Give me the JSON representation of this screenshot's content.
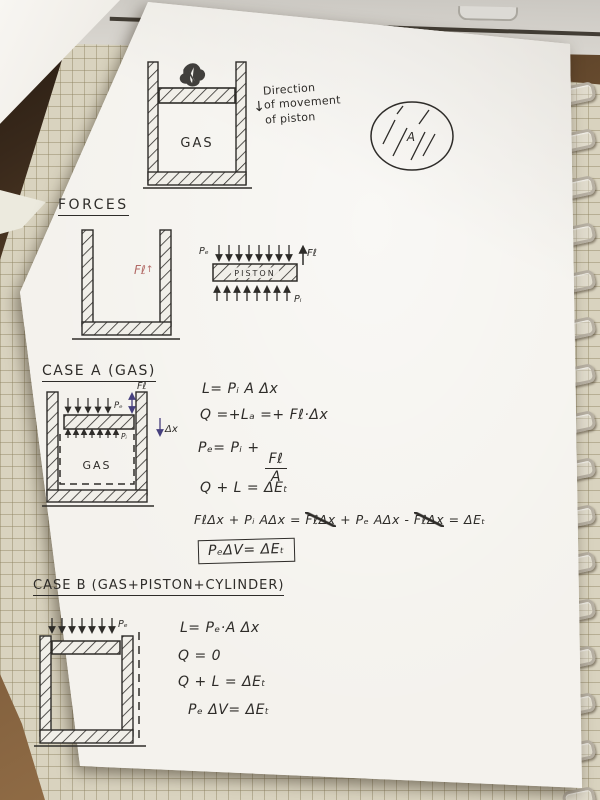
{
  "colors": {
    "black_ink": "#2e2c29",
    "purple_ink": "#46407e",
    "red_ink": "#b26a66",
    "paper_white": "#f2f0ea",
    "grid_paper": "#d9d3bf",
    "wood_desk": "#7d5c3b",
    "spiral_metal": "#b7b0a3"
  },
  "top_diagram": {
    "gas_label": "GAS",
    "direction_note_line1": "Direction",
    "direction_note_line2": "of movement",
    "direction_note_line3": "of piston",
    "direction_arrow": "↓",
    "area_circle_label": "A"
  },
  "forces_section": {
    "heading": "FORCES",
    "friction_label": "Fℓ",
    "friction_arrow": "↑",
    "piston_fbd": {
      "external_pressure_label": "Pₑ",
      "piston_label": "PISTON",
      "friction_force_label": "Fℓ",
      "internal_pressure_label": "Pᵢ"
    }
  },
  "case_a": {
    "heading": "CASE A (GAS)",
    "diagram": {
      "external_pressure_label": "Pₑ",
      "friction_force_label": "Fℓ",
      "internal_pressure_label": "Pᵢ",
      "gas_label": "GAS",
      "displacement_label": "Δx"
    },
    "equations": {
      "work": "L= Pᵢ A Δx",
      "heat": "Q =+Lₐ =+ Fℓ·Δx",
      "pressure_prefix": "Pₑ= Pᵢ +",
      "fraction_numerator": "Fℓ",
      "fraction_denominator": "A",
      "first_law": "Q + L = ΔEₜ",
      "expanded_seg1": "FℓΔx + Pᵢ AΔx = ",
      "expanded_seg2_struck": "FℓΔx",
      "expanded_seg3": " + Pₑ AΔx - ",
      "expanded_seg4_struck": "FℓΔx",
      "expanded_seg5": " = ΔEₜ",
      "boxed_result": "PₑΔV= ΔEₜ"
    }
  },
  "case_b": {
    "heading": "CASE B (GAS+PISTON+CYLINDER)",
    "diagram": {
      "external_pressure_label": "Pₑ"
    },
    "equations": {
      "work": "L= Pₑ·A Δx",
      "heat": "Q = 0",
      "first_law": "Q + L = ΔEₜ",
      "result": "Pₑ ΔV= ΔEₜ"
    }
  }
}
